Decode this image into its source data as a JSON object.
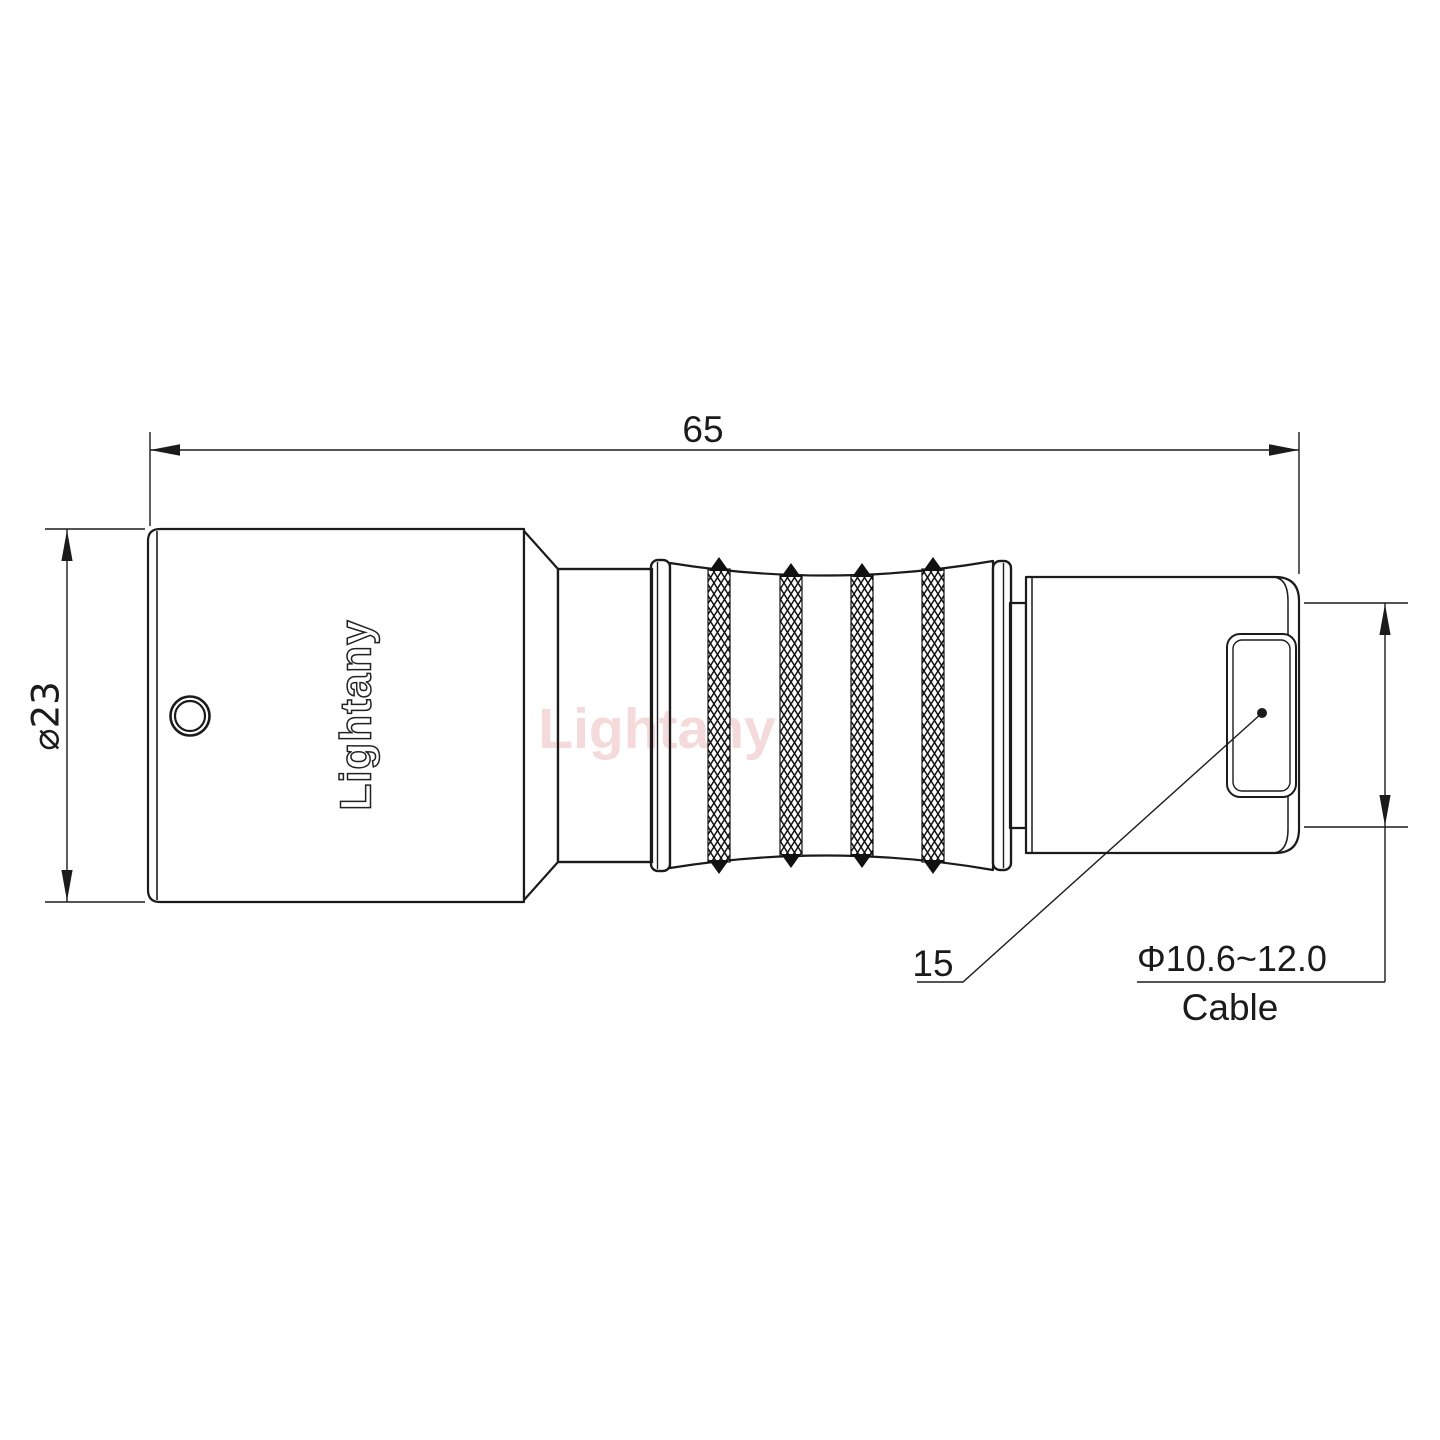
{
  "drawing": {
    "colors": {
      "background": "#ffffff",
      "line": "#1b1b1b",
      "watermark_pink": "#eec2c2"
    },
    "watermark": "Lightany",
    "body_logo": "Lightany",
    "dimensions": {
      "overall_length": "65",
      "body_diameter": "⌀23",
      "rear_section": "15",
      "cable_diameter_range": "Φ10.6~12.0",
      "cable_caption": "Cable"
    }
  }
}
